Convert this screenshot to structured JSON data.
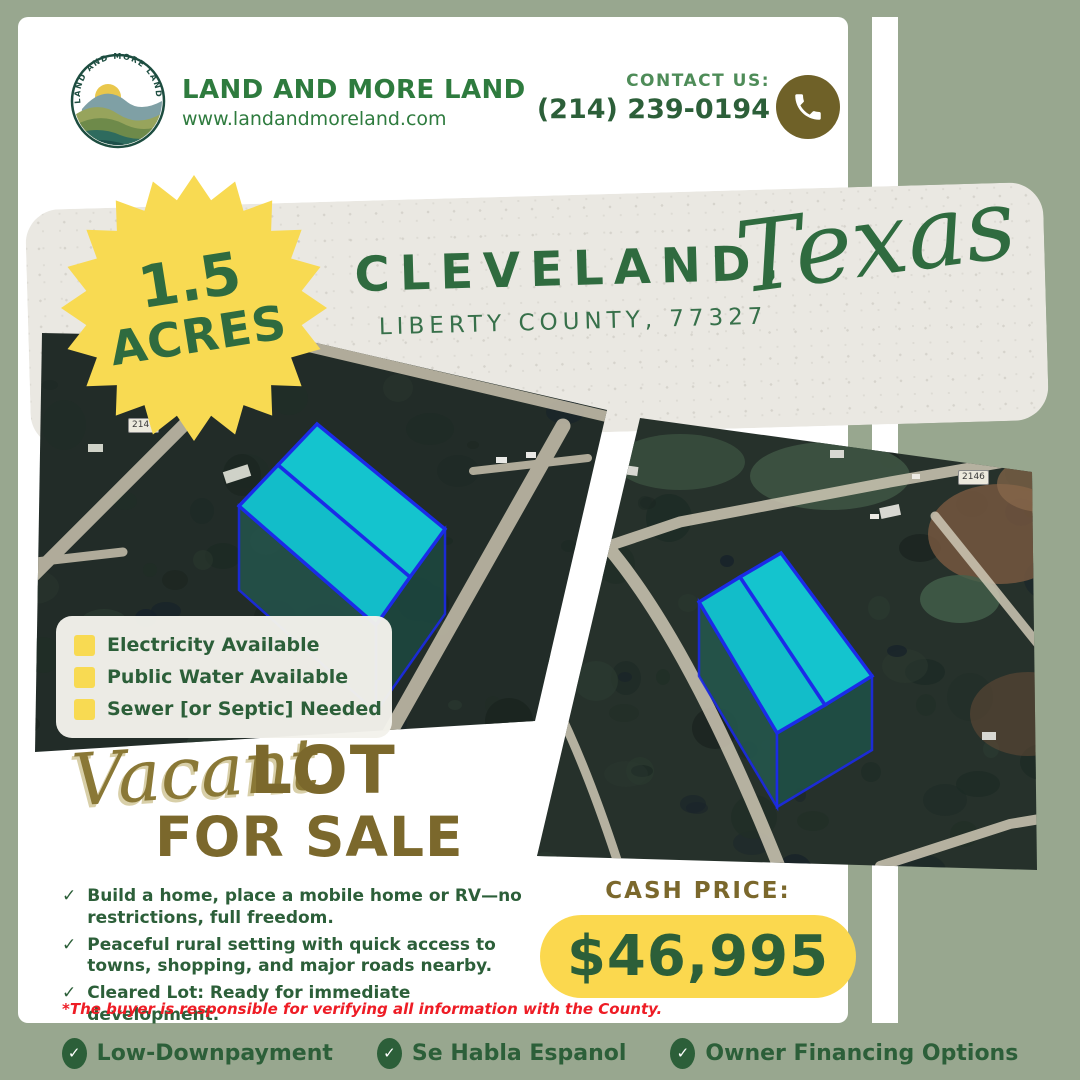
{
  "header": {
    "logo_arc": "LAND AND MORE LAND",
    "brand_name": "LAND AND MORE LAND",
    "website": "www.landandmoreland.com",
    "contact_label": "CONTACT US:",
    "phone": "(214) 239-0194"
  },
  "badge": {
    "value": "1.5",
    "unit": "ACRES"
  },
  "banner": {
    "city": "CLEVELAND,",
    "county_zip": "LIBERTY COUNTY, 77327",
    "state": "Texas"
  },
  "maps": {
    "left": {
      "road_label": "2147"
    },
    "right": {
      "road_label": "2146"
    }
  },
  "features": {
    "items": [
      "Electricity Available",
      "Public Water Available",
      "Sewer [or Septic] Needed"
    ]
  },
  "sale": {
    "script": "Vacant",
    "big": "LOT",
    "sub": "FOR SALE"
  },
  "benefits": {
    "items": [
      "Build a home, place a mobile home or RV—no restrictions, full freedom.",
      "Peaceful rural setting with quick access to towns, shopping, and major roads nearby.",
      "Cleared Lot: Ready for immediate development."
    ]
  },
  "price": {
    "label": "CASH PRICE:",
    "amount": "$46,995"
  },
  "disclaimer": "*The buyer is responsible for verifying all information with the County.",
  "footer": {
    "items": [
      "Low-Downpayment",
      "Se Habla Espanol",
      "Owner Financing Options"
    ]
  },
  "icons": {
    "check": "✓",
    "phone": "phone-icon",
    "feature_marker": "yellow-square-icon"
  },
  "colors": {
    "background_sage": "#98A78F",
    "card_white": "#FFFFFF",
    "brand_green": "#2E7B3E",
    "dark_green": "#2C5F39",
    "title_green": "#2F6B3F",
    "olive": "#7B682C",
    "olive_dark": "#6F6128",
    "badge_yellow": "#F8DA52",
    "price_yellow": "#FBD84E",
    "alert_red": "#EE1C25",
    "lot_cyan": "#14C4CE",
    "lot_outline_blue": "#1B2BE8",
    "paper": "#EAE8E2"
  }
}
